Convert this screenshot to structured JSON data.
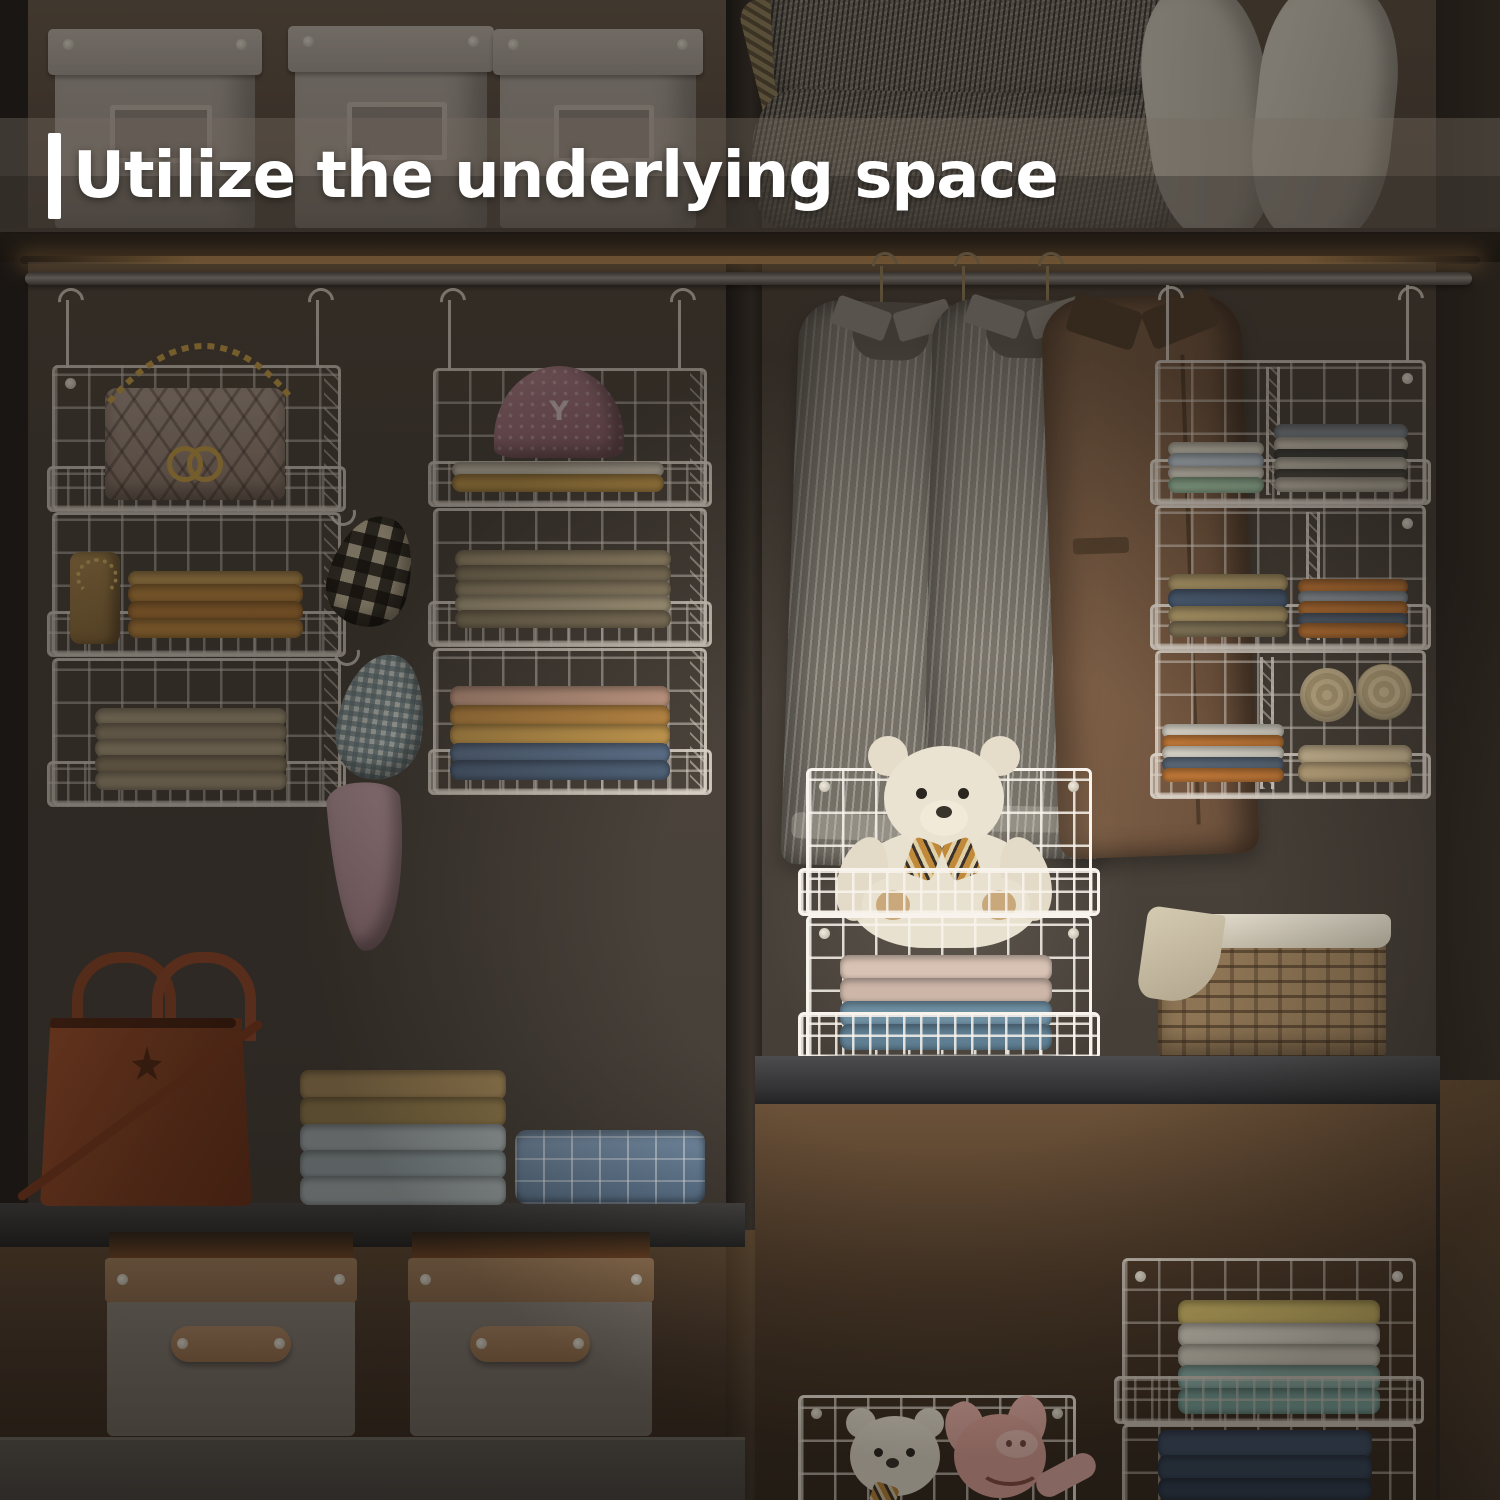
{
  "title": {
    "bar": "|",
    "text": "Utilize the underlying space",
    "text_color": "#ffffff",
    "banner_color": "rgba(118,108,98,0.40)"
  },
  "cap_monogram": "Y",
  "palette": {
    "wall": "#4a423a",
    "wall_dark": "#332d27",
    "shelf_dark": "#262019",
    "led_glow": "#a97f4c",
    "wire_dim": "#d8d0c5",
    "wire_bright": "#f8f4ed",
    "storage_box_white": "#b3aaa1",
    "leather_tote_brown": "#96492b",
    "teddy_cream": "#e9e1cf",
    "pig_pink": "#e5a89e",
    "wicker_tan": "#8d7454",
    "quilted_bag_beige": "#ad9a8d",
    "gold_hardware": "#c9a04a",
    "jacket_brown": "#7b5c44",
    "denim_blue": "#3e5068",
    "mustard": "#c08a42"
  },
  "stacks": {
    "o1t2": [
      [
        "#caa05a",
        16
      ],
      [
        "#c08a42",
        20
      ],
      [
        "#b97e3a",
        20
      ],
      [
        "#c08a42",
        20
      ]
    ],
    "o1t3": [
      [
        "#b0a184",
        18
      ],
      [
        "#a29278",
        19
      ],
      [
        "#b0a184",
        19
      ],
      [
        "#99896e",
        19
      ],
      [
        "#a89a7e",
        19
      ]
    ],
    "o2t1": [
      [
        "#d6cbb8",
        15
      ],
      [
        "#c49a4e",
        18
      ]
    ],
    "o2t2": [
      [
        "#a39374",
        18
      ],
      [
        "#8f8166",
        18
      ],
      [
        "#9c8d70",
        18
      ],
      [
        "#b2a486",
        18
      ],
      [
        "#8a7c62",
        18
      ]
    ],
    "o2t3": [
      [
        "#c59c86",
        22
      ],
      [
        "#bd8a46",
        22
      ],
      [
        "#c59a50",
        22
      ],
      [
        "#5d7089",
        20
      ],
      [
        "#51637a",
        20
      ]
    ],
    "rt1l": [
      [
        "#d8d2c2",
        14
      ],
      [
        "#b8c4cc",
        16
      ],
      [
        "#e0dacc",
        14
      ],
      [
        "#9fc0a2",
        16
      ]
    ],
    "rt1r": [
      [
        "#8a9298",
        16
      ],
      [
        "#d8d0c0",
        15
      ],
      [
        "#4a4a46",
        11
      ],
      [
        "#cfc8b8",
        15
      ],
      [
        "#55514a",
        11
      ],
      [
        "#c8c0b0",
        15
      ]
    ],
    "rt2l": [
      [
        "#b09a6a",
        18
      ],
      [
        "#4e6078",
        20
      ],
      [
        "#b09a6a",
        18
      ],
      [
        "#8a7c5e",
        16
      ]
    ],
    "rt2r": [
      [
        "#c07838",
        15
      ],
      [
        "#98a0a8",
        13
      ],
      [
        "#c07838",
        15
      ],
      [
        "#5a6878",
        13
      ],
      [
        "#c07838",
        15
      ]
    ],
    "rt3l": [
      [
        "#d8d4c8",
        14
      ],
      [
        "#c07838",
        14
      ],
      [
        "#d8d4c8",
        14
      ],
      [
        "#5a6878",
        14
      ],
      [
        "#c07838",
        14
      ]
    ],
    "rt3r": [
      [
        "#cbb894",
        20
      ],
      [
        "#bfa87f",
        20
      ]
    ],
    "tb2": [
      [
        "#d8c2b4",
        26
      ],
      [
        "#cdb6a8",
        26
      ],
      [
        "#6f8fa2",
        26
      ],
      [
        "#5f7e92",
        26
      ]
    ],
    "shelfL": [
      [
        "#a5895a",
        30
      ],
      [
        "#97804f",
        30
      ],
      [
        "#a8b2b4",
        29
      ],
      [
        "#9aa8ac",
        29
      ],
      [
        "#a8b2b4",
        29
      ]
    ],
    "brShirts": [
      [
        "#d2bc6a",
        26
      ],
      [
        "#ddd8cb",
        24
      ],
      [
        "#d5d0c2",
        24
      ],
      [
        "#8fb5ad",
        26
      ],
      [
        "#7da8a0",
        26
      ]
    ],
    "brJeans": [
      [
        "#3e5068",
        28
      ],
      [
        "#35465c",
        26
      ],
      [
        "#2e3e52",
        22
      ]
    ]
  }
}
